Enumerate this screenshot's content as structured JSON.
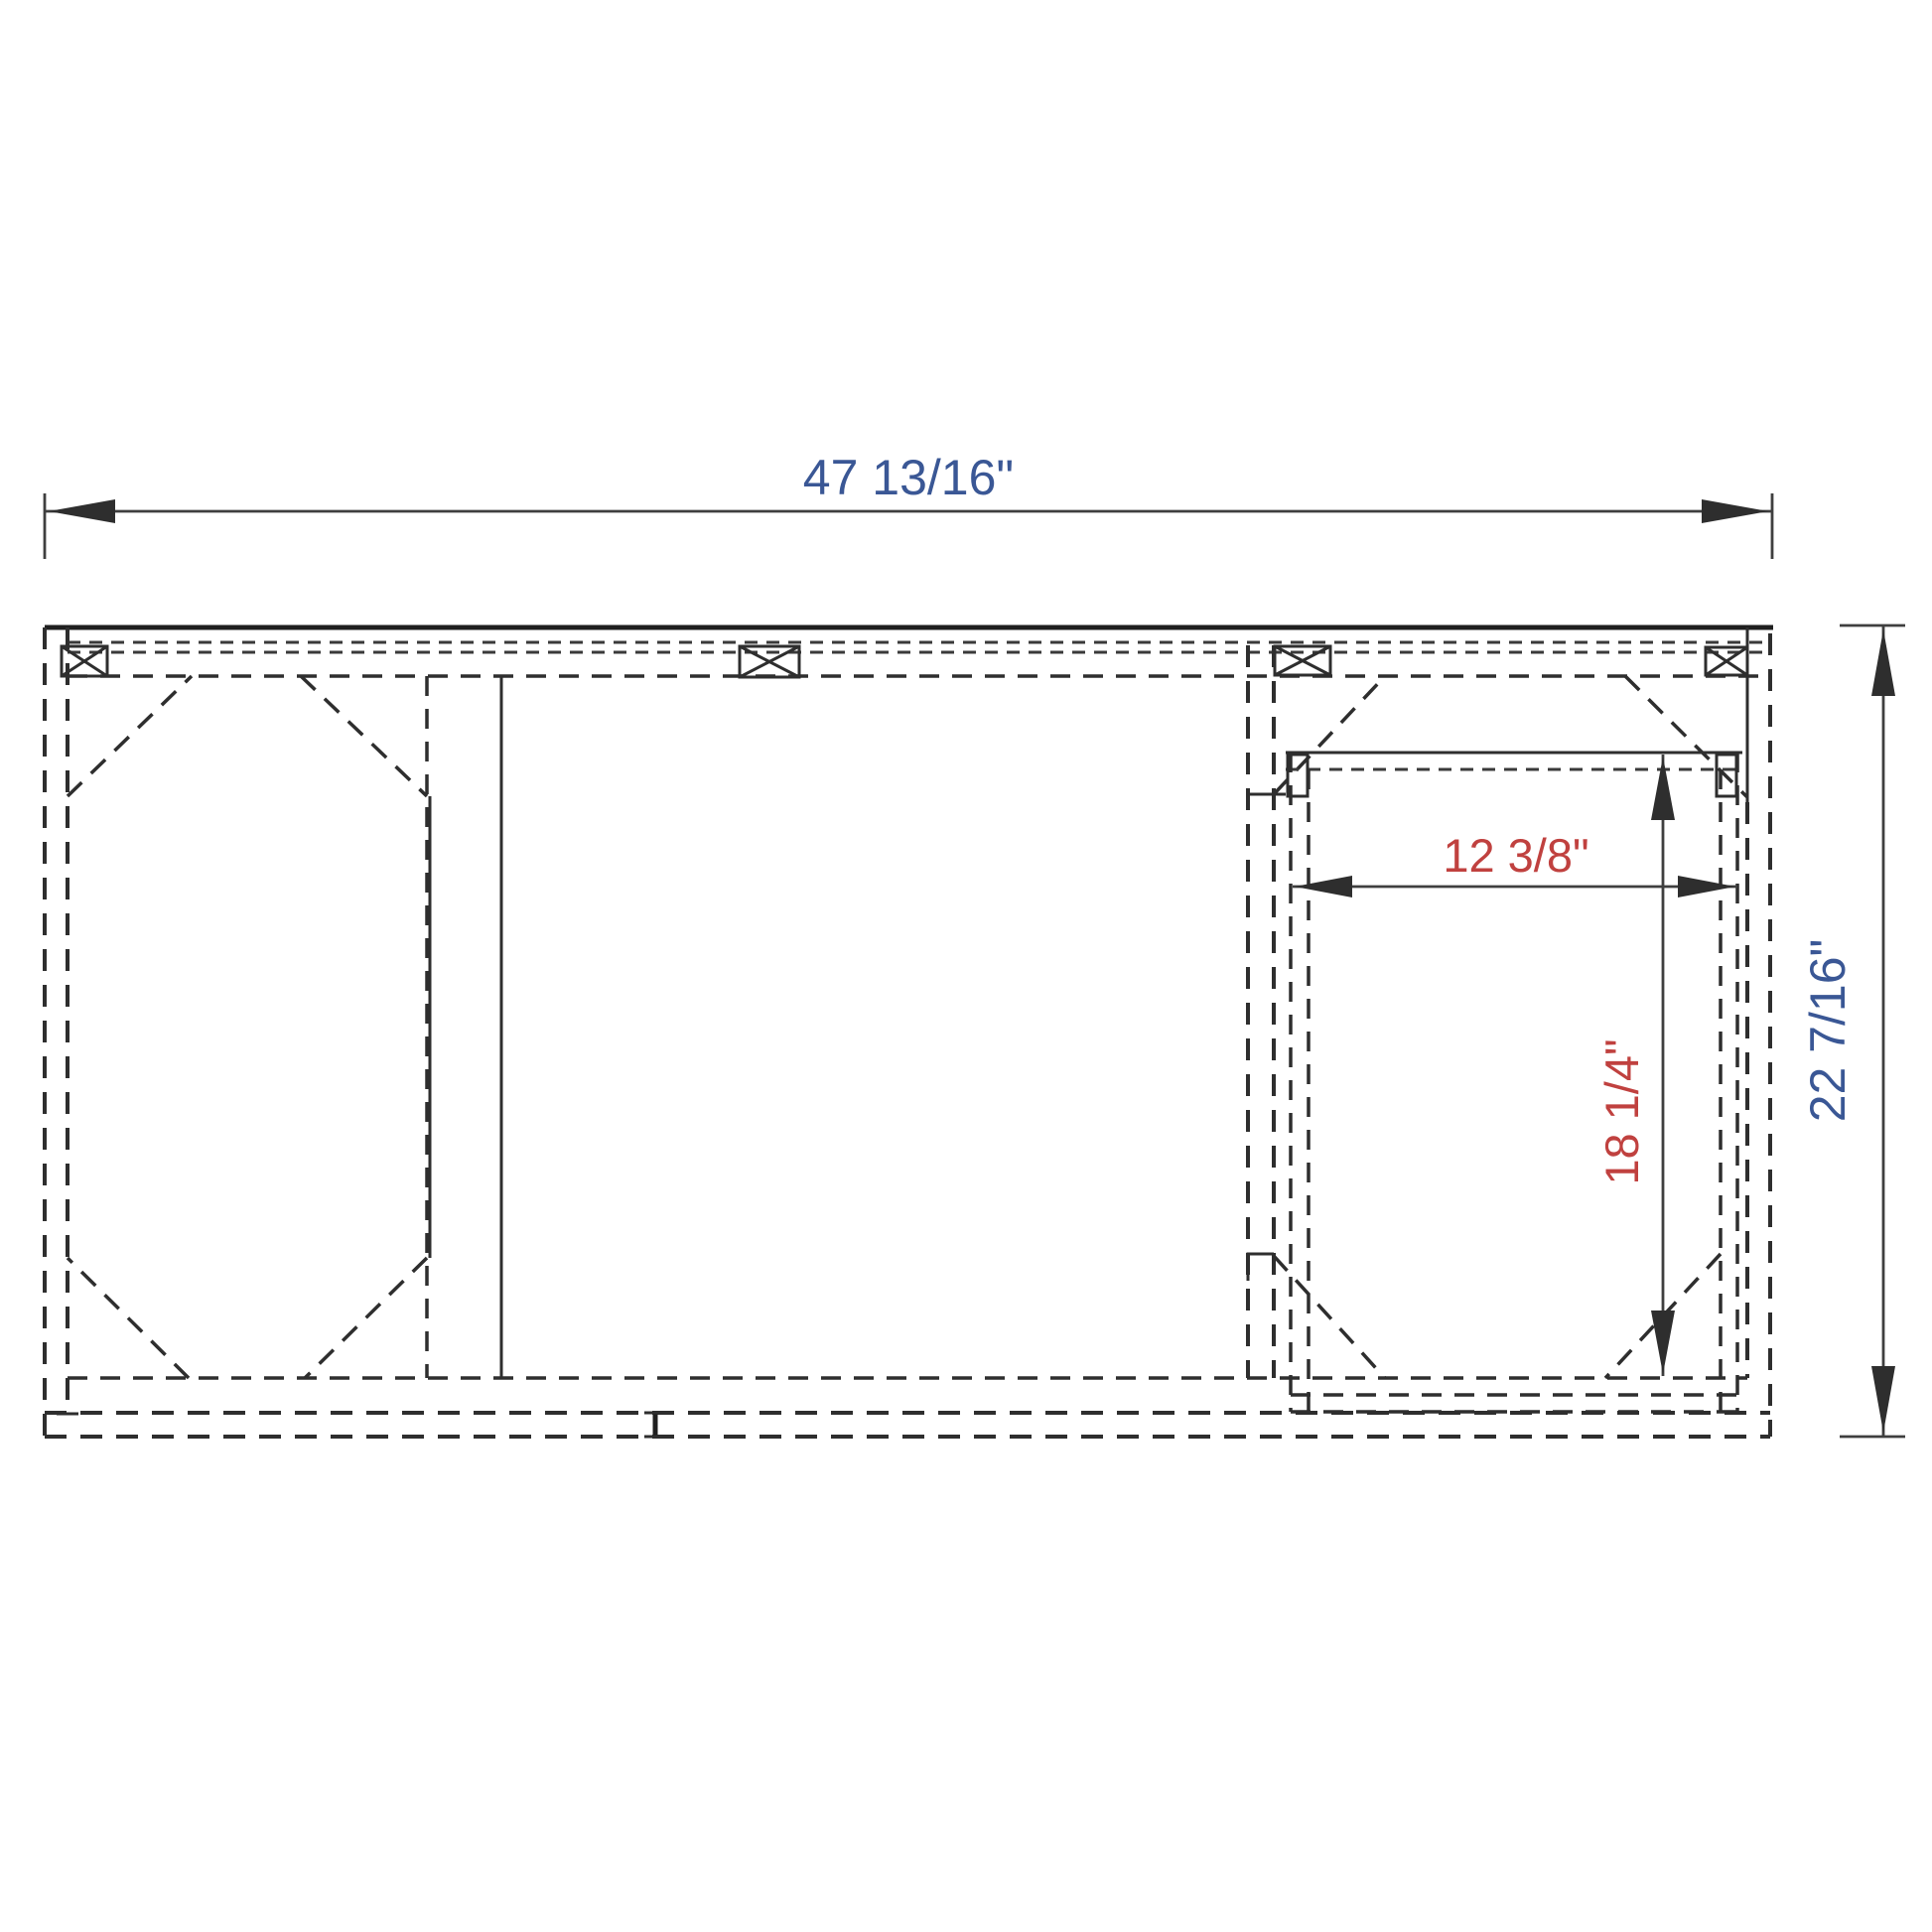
{
  "drawing": {
    "colors": {
      "dimension_blue": "#3a5795",
      "dimension_red": "#c0413f",
      "line_dark": "#2e2e2e"
    },
    "dimensions": {
      "overall_width": {
        "label": "47 13/16\""
      },
      "overall_height": {
        "label": "22 7/16\""
      },
      "opening_width": {
        "label": "12 3/8\""
      },
      "opening_height": {
        "label": "18 1/4\""
      }
    }
  }
}
